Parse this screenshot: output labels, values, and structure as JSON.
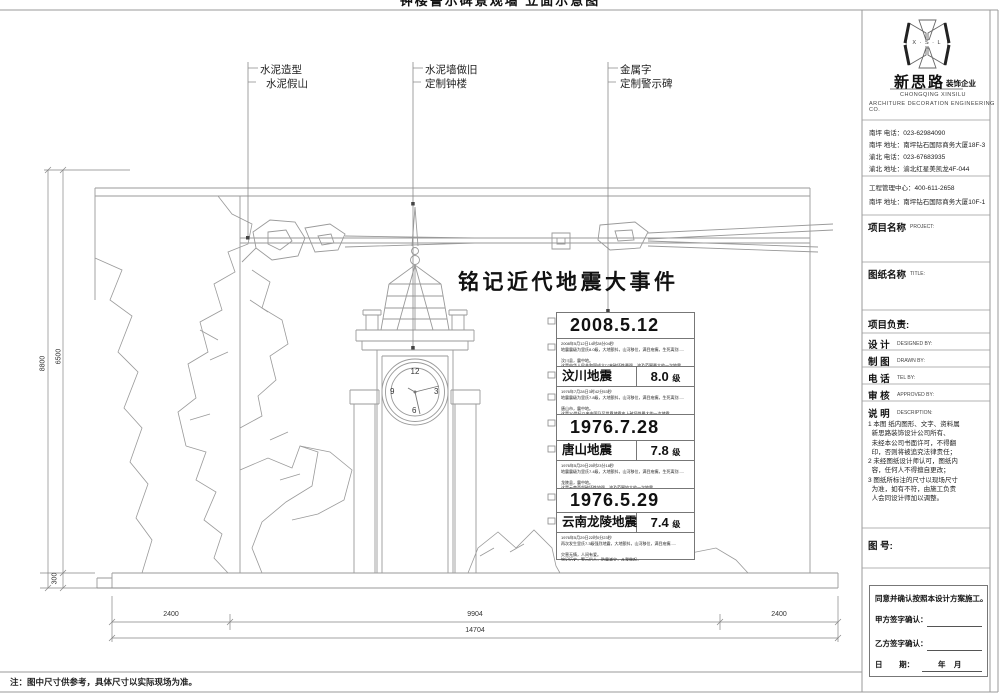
{
  "sheet": {
    "clipped_top_title": "钟楼警示碑景观墙 立面示意图",
    "leader_labels": [
      {
        "line1": "水泥造型",
        "line2": "水泥假山"
      },
      {
        "line1": "水泥墙做旧",
        "line2": "定制钟楼"
      },
      {
        "line1": "金属字",
        "line2": "定制警示碑"
      }
    ],
    "main_title": "铭记近代地震大事件",
    "clock": {
      "n12": "12",
      "n3": "3",
      "n6": "6",
      "n9": "9"
    },
    "stele_rows": [
      {
        "date": "2008.5.12"
      },
      {
        "desc": "2008年5月12日14时28分04秒\n地震震级为里氏8.0级，大地颤抖，山河移位，满目疮痍，生死离别.....\n\n汶川县，震中地。\n这是中华人民共和国成立以来破坏性最强、波及范围最大的一次地震，\n地震重创约50万平方公里的中国大地"
      },
      {
        "name": "汶川地震",
        "mag": "8.0",
        "unit": "级"
      },
      {
        "desc": "1976年7月28日3时42分53秒\n地震震级为里氏7.8级，大地颤抖，山河移位，满目疮痍，生死离别.....\n\n唐山市，震中地。\n这是20世纪以来中国乃至世界地震史上破坏性最大的一次地震，\n地震重创约3万平方公里的华北大地"
      },
      {
        "date": "1976.7.28"
      },
      {
        "name": "唐山地震",
        "mag": "7.8",
        "unit": "级"
      },
      {
        "desc": "1976年5月29日20时23分18秒\n地震震级为里氏7.4级，大地颤抖，山河移位，满目疮痍，生死离别.....\n\n龙陵县，震中地。\n这是云南西部破坏性较强、波及范围较大的一次地震，\n地震波及约2万平方公里的云南大地"
      },
      {
        "date": "1976.5.29"
      },
      {
        "name": "云南龙陵地震",
        "mag": "7.4",
        "unit": "级"
      },
      {
        "desc": "1976年5月29日22时0分23秒\n再次发生里氏7.3级强烈地震，大地颤抖，山河移位，满目疮痍.....\n\n灾害无情，人间有爱。\n铭记历史，警示后人，防震减灾，从我做起，\n共同守护我们赖以生存的家园大地"
      }
    ],
    "dimensions": {
      "bottom_segments": [
        "2400",
        "9904",
        "2400"
      ],
      "bottom_total": "14704",
      "left_outer": "8800",
      "left_inner": "6500",
      "left_base": "300"
    },
    "footnote": "注：图中尺寸供参考，具体尺寸以实际现场为准。"
  },
  "title_block": {
    "logo": {
      "mark_text": "X · S · L",
      "company_cn": "新思路",
      "company_suffix": "装饰企业",
      "company_en1": "CHONGQING XINSILU",
      "company_en2": "ARCHITURE DECORATION ENGINEERING CO."
    },
    "contact": {
      "lines": [
        "南坪 电话：023-62984090",
        "南坪 地址：南坪钻石国际商务大厦18F-3",
        "渝北 电话：023-67683935",
        "渝北 地址：渝北红星美凯龙4F-044"
      ],
      "lines2": [
        "工程管理中心：400-611-2658",
        "南坪 地址：南坪钻石国际商务大厦10F-1"
      ]
    },
    "fields": {
      "project_label": "项目名称",
      "project_en": "PROJECT:",
      "title_label": "图纸名称",
      "title_en": "TITLE:",
      "manager_label": "项目负责:",
      "design_label": "设 计",
      "design_en": "DESIGNED BY:",
      "draw_label": "制 图",
      "draw_en": "DRAWN BY:",
      "tel_label": "电 话",
      "tel_en": "TEL BY:",
      "approve_label": "审 核",
      "approve_en": "APPROVED BY:",
      "desc_label": "说 明",
      "desc_en": "DESCRIPTION:"
    },
    "notes": "1 本图 纸内图形、文字、资料属\n  新思路装饰设计公司所有、\n  未经本公司书面许可，不得翻\n  印，否则将被追究法律责任；\n2 未经图纸设计师认可，图纸内\n  容，任何人不得擅自更改；\n3 图纸所标注的尺寸以现场尺寸\n  为准，如有不符，由施工负责\n  人会同设计师加以调整。",
    "drawing_no_label": "图 号:",
    "signature": {
      "agree": "同意并确认按照本设计方案施工。",
      "party_a": "甲方签字确认：",
      "party_b": "乙方签字确认：",
      "date_label": "日        期：",
      "date_suffix": "年    月"
    }
  }
}
